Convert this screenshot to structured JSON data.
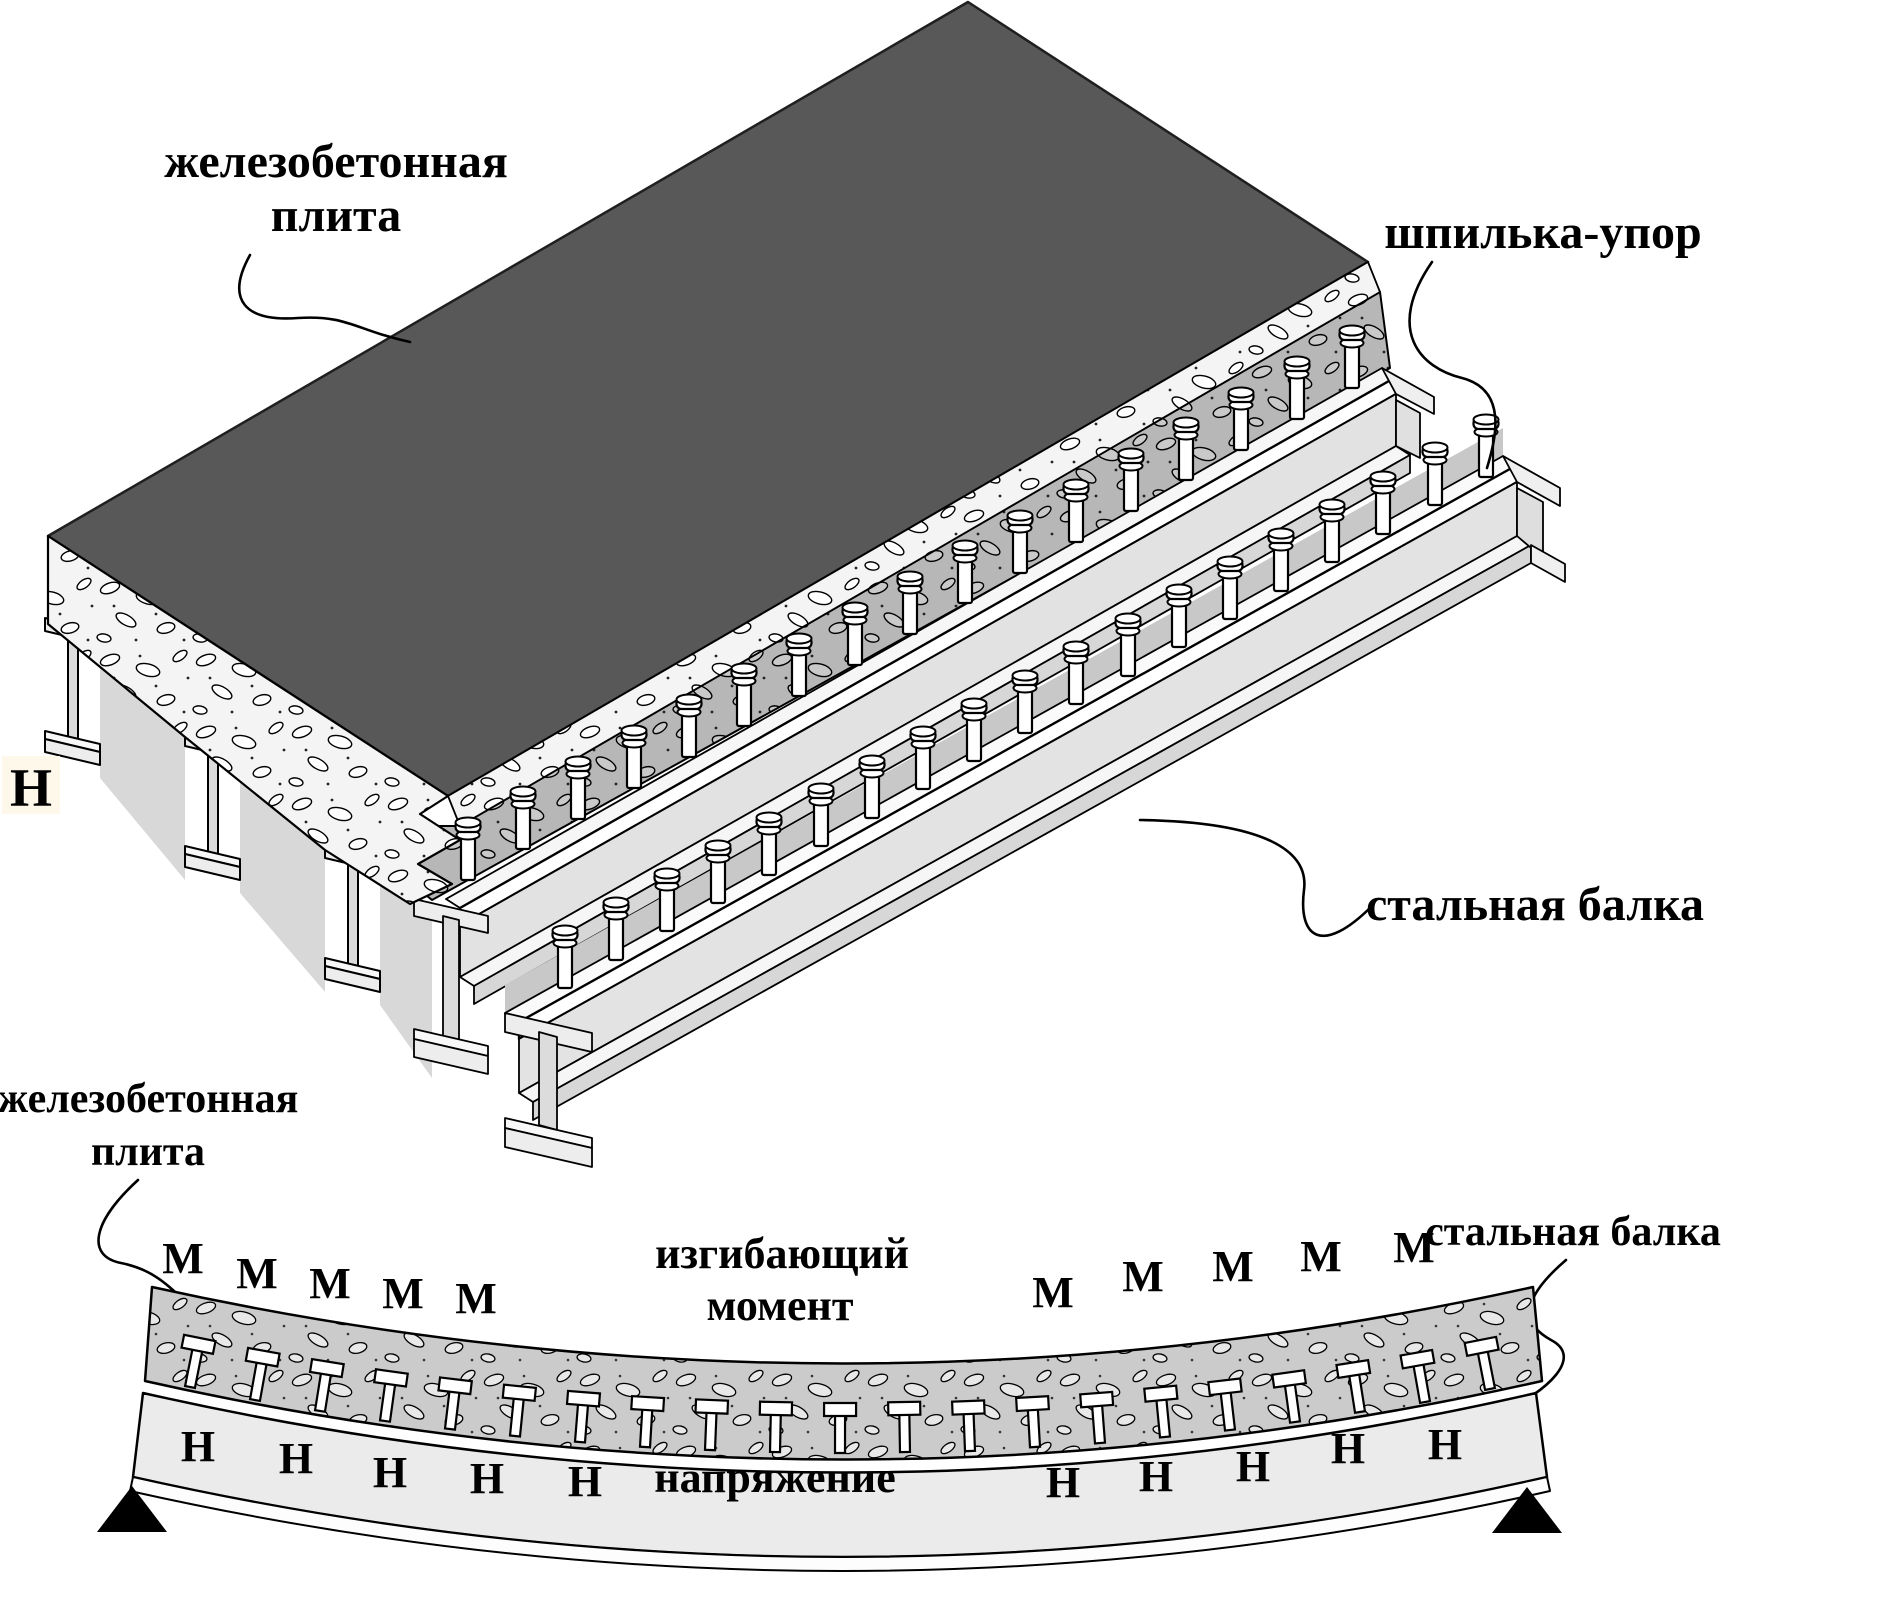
{
  "diagram": {
    "labels": {
      "top_slab_line1": "железобетонная",
      "top_slab_line2": "плита",
      "stud_label": "шпилька-упор",
      "steel_beam_top": "стальная балка",
      "bottom_slab_line1": "железобетонная",
      "bottom_slab_line2": "плита",
      "steel_beam_bottom": "стальная балка",
      "bending_moment_line1": "изгибающий",
      "bending_moment_line2": "момент",
      "stress_label": "напряжение"
    },
    "symbols": {
      "moment": "M",
      "stress": "H",
      "section": "H"
    },
    "counts": {
      "moment_marks": 10,
      "stress_marks": 10,
      "studs_on_detached_beam": 19,
      "studs_embedded_in_strip": 17,
      "studs_in_bent_beam": 21,
      "supports": 2,
      "cross_beams_under_slab": 3
    },
    "colors": {
      "slab_top": "#585858",
      "concrete_light": "#f4f4f4",
      "concrete_dark_strip": "#b7b7b7",
      "concrete_bent": "#cbcbcb",
      "steel_flange": "#ffffff",
      "steel_web": "#e3e3e3",
      "steel_band": "#ebebeb",
      "steel_shadow": "#c8c8c8",
      "outline": "#000000",
      "support": "#000000"
    }
  }
}
